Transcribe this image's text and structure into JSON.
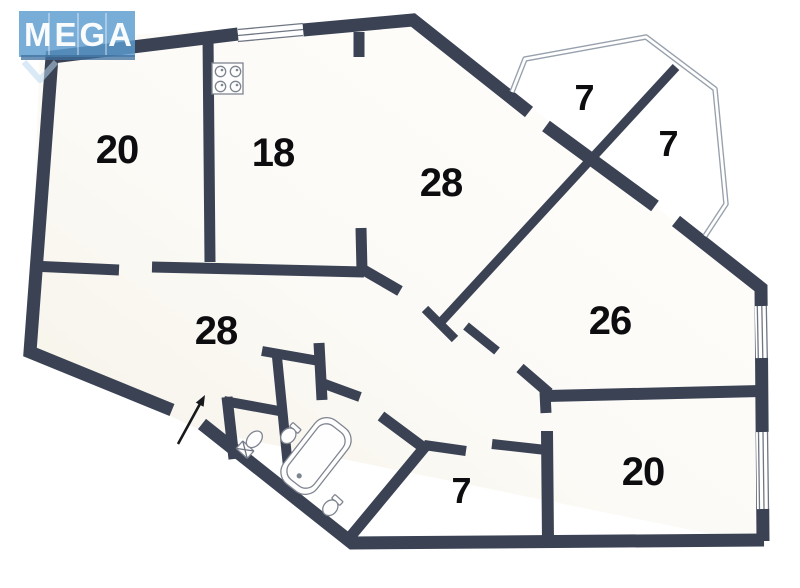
{
  "watermark": {
    "text": "MEGA",
    "color": "#5a9bd0"
  },
  "plan": {
    "wall_color": "#3a4254",
    "railing_color": "#97a0ac",
    "label_color": "#0d0d10",
    "rooms": [
      {
        "name": "room-top-left",
        "area": "20"
      },
      {
        "name": "kitchen",
        "area": "18"
      },
      {
        "name": "room-center",
        "area": "28"
      },
      {
        "name": "balcony-left",
        "area": "7"
      },
      {
        "name": "balcony-right",
        "area": "7"
      },
      {
        "name": "living-room",
        "area": "28"
      },
      {
        "name": "room-right",
        "area": "26"
      },
      {
        "name": "hall",
        "area": "7"
      },
      {
        "name": "room-bottom-right",
        "area": "20"
      }
    ],
    "fixtures": [
      "stove-icon",
      "toilet-icon",
      "sink-icon",
      "bathtub-icon",
      "sink-icon",
      "entrance-arrow-icon"
    ]
  }
}
